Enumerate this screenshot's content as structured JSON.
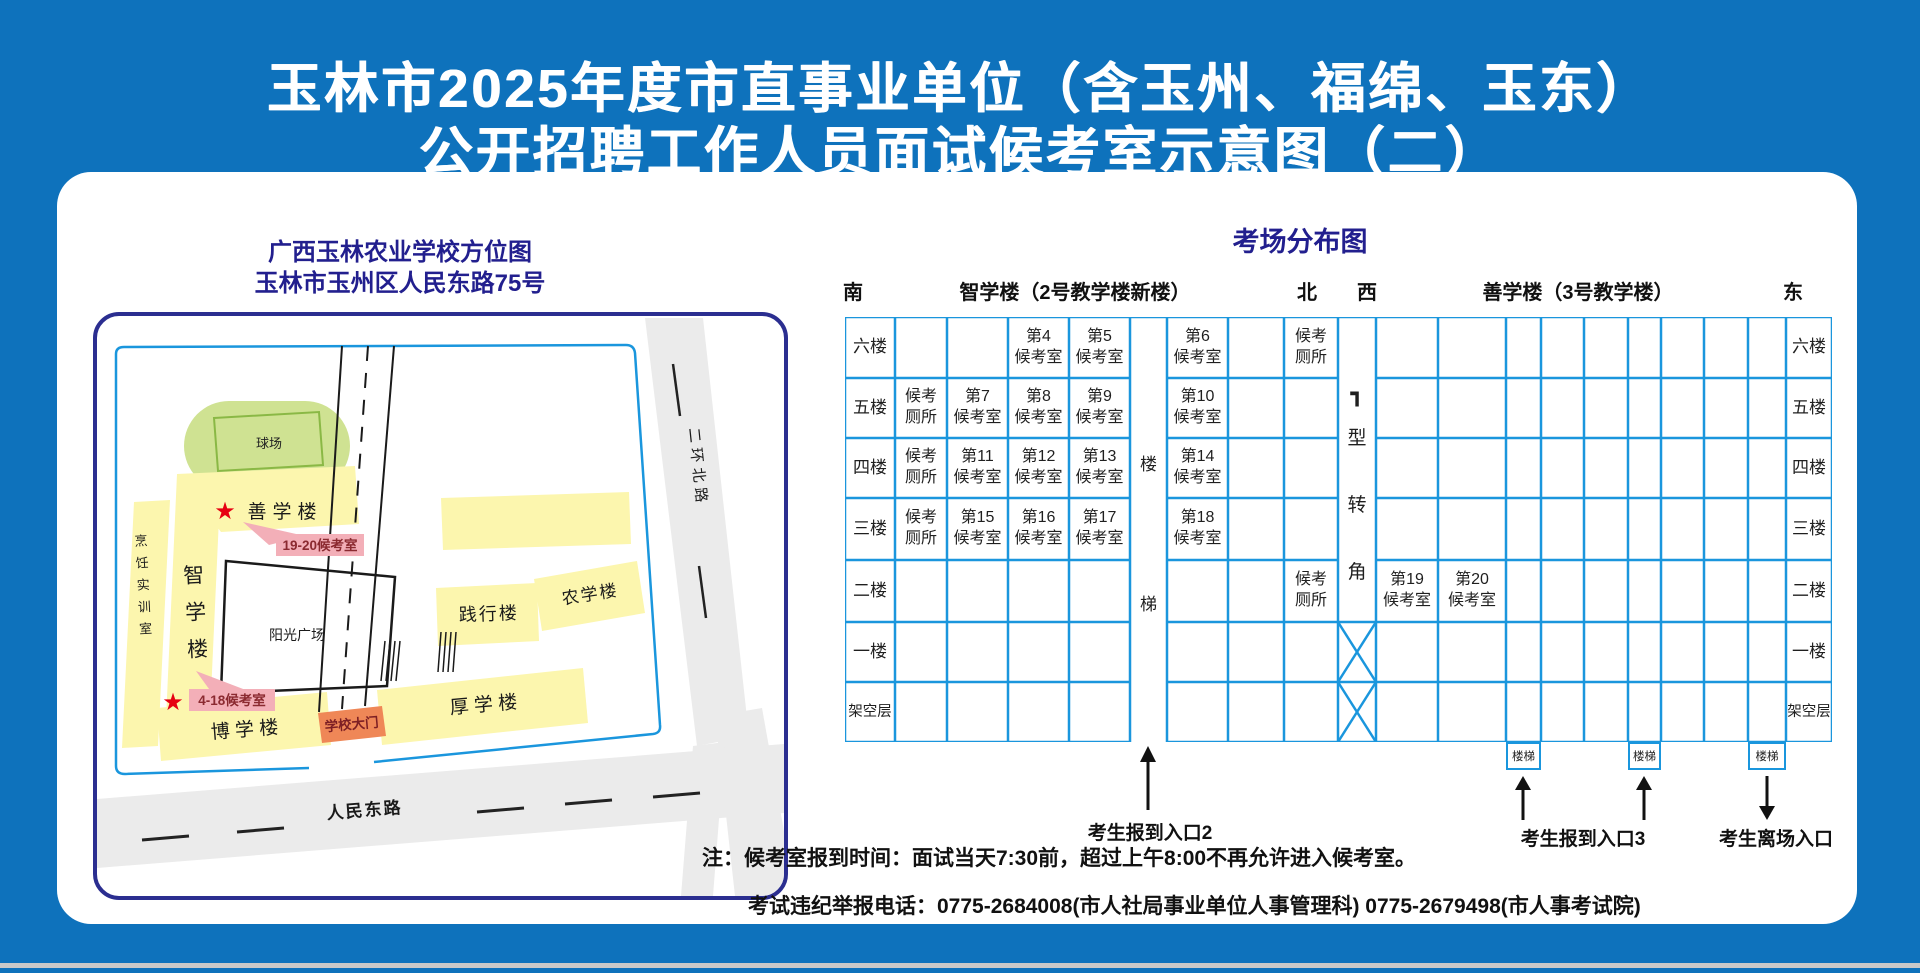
{
  "title": {
    "line1": "玉林市2025年度市直事业单位（含玉州、福绵、玉东）",
    "line2": "公开招聘工作人员面试候考室示意图（二）"
  },
  "map": {
    "header_line1": "广西玉林农业学校方位图",
    "header_line2": "玉林市玉州区人民东路75号",
    "labels": {
      "field": "球场",
      "shanxue": "善学楼",
      "zhixue": "智学楼",
      "cooking": "烹饪实训室",
      "plaza": "阳光广场",
      "boxue": "博 学 楼",
      "gate": "学校大门",
      "houxue": "厚 学 楼",
      "jianxing": "践行楼",
      "nongxue": "农学楼",
      "renmin_road": "人民东路",
      "erhuan_road": "二环北路",
      "rooms_19_20": "19-20候考室",
      "rooms_4_18": "4-18候考室",
      "star": "★"
    }
  },
  "distribution": {
    "title": "考场分布图",
    "compass_south": "南",
    "compass_north": "北",
    "compass_west": "西",
    "compass_east": "东",
    "building_left": "智学楼（2号教学楼新楼）",
    "building_right": "善学楼（3号教学楼）",
    "floors": [
      "六楼",
      "五楼",
      "四楼",
      "三楼",
      "二楼",
      "一楼",
      "架空层"
    ],
    "stair_label": "楼梯",
    "corner_symbol": "┓",
    "corner_label": "型转角",
    "stair_box_label": "楼梯",
    "entrance2": "考生报到入口2",
    "entrance3": "考生报到入口3",
    "exit_label": "考生离场入口",
    "cells": [
      [
        "",
        "",
        "第4\n候考室",
        "第5\n候考室",
        "第6\n候考室",
        "",
        "候考\n厕所",
        "",
        "",
        "",
        "",
        "",
        "",
        "",
        "",
        ""
      ],
      [
        "候考\n厕所",
        "第7\n候考室",
        "第8\n候考室",
        "第9\n候考室",
        "第10\n候考室",
        "",
        "",
        "",
        "",
        "",
        "",
        "",
        "",
        "",
        "",
        ""
      ],
      [
        "候考\n厕所",
        "第11\n候考室",
        "第12\n候考室",
        "第13\n候考室",
        "第14\n候考室",
        "",
        "",
        "",
        "",
        "",
        "",
        "",
        "",
        "",
        "",
        ""
      ],
      [
        "候考\n厕所",
        "第15\n候考室",
        "第16\n候考室",
        "第17\n候考室",
        "第18\n候考室",
        "",
        "",
        "",
        "",
        "",
        "",
        "",
        "",
        "",
        "",
        ""
      ],
      [
        "",
        "",
        "",
        "",
        "",
        "",
        "候考\n厕所",
        "第19\n候考室",
        "第20\n候考室",
        "",
        "",
        "",
        "",
        "",
        "",
        ""
      ],
      [
        "",
        "",
        "",
        "",
        "",
        "",
        "",
        "",
        "",
        "",
        "",
        "",
        "",
        "",
        "",
        ""
      ],
      [
        "",
        "",
        "",
        "",
        "",
        "",
        "",
        "",
        "",
        "",
        "",
        "",
        "",
        "",
        "",
        ""
      ]
    ]
  },
  "notes": {
    "line1": "注：候考室报到时间：面试当天7:30前，超过上午8:00不再允许进入候考室。",
    "line2": "考试违纪举报电话：0775-2684008(市人社局事业单位人事管理科)  0775-2679498(市人事考试院)"
  },
  "colors": {
    "background": "#0e72bc",
    "grid_line": "#1a96dd",
    "heading_indigo": "#221f8e",
    "building_fill": "#fcf6ae",
    "field_green": "#cfe292",
    "pink_label": "#f3afb8",
    "pink_text": "#8b2a30",
    "gate_orange": "#ef8757",
    "star_red": "#e60012",
    "road_gray": "#ebebeb"
  }
}
